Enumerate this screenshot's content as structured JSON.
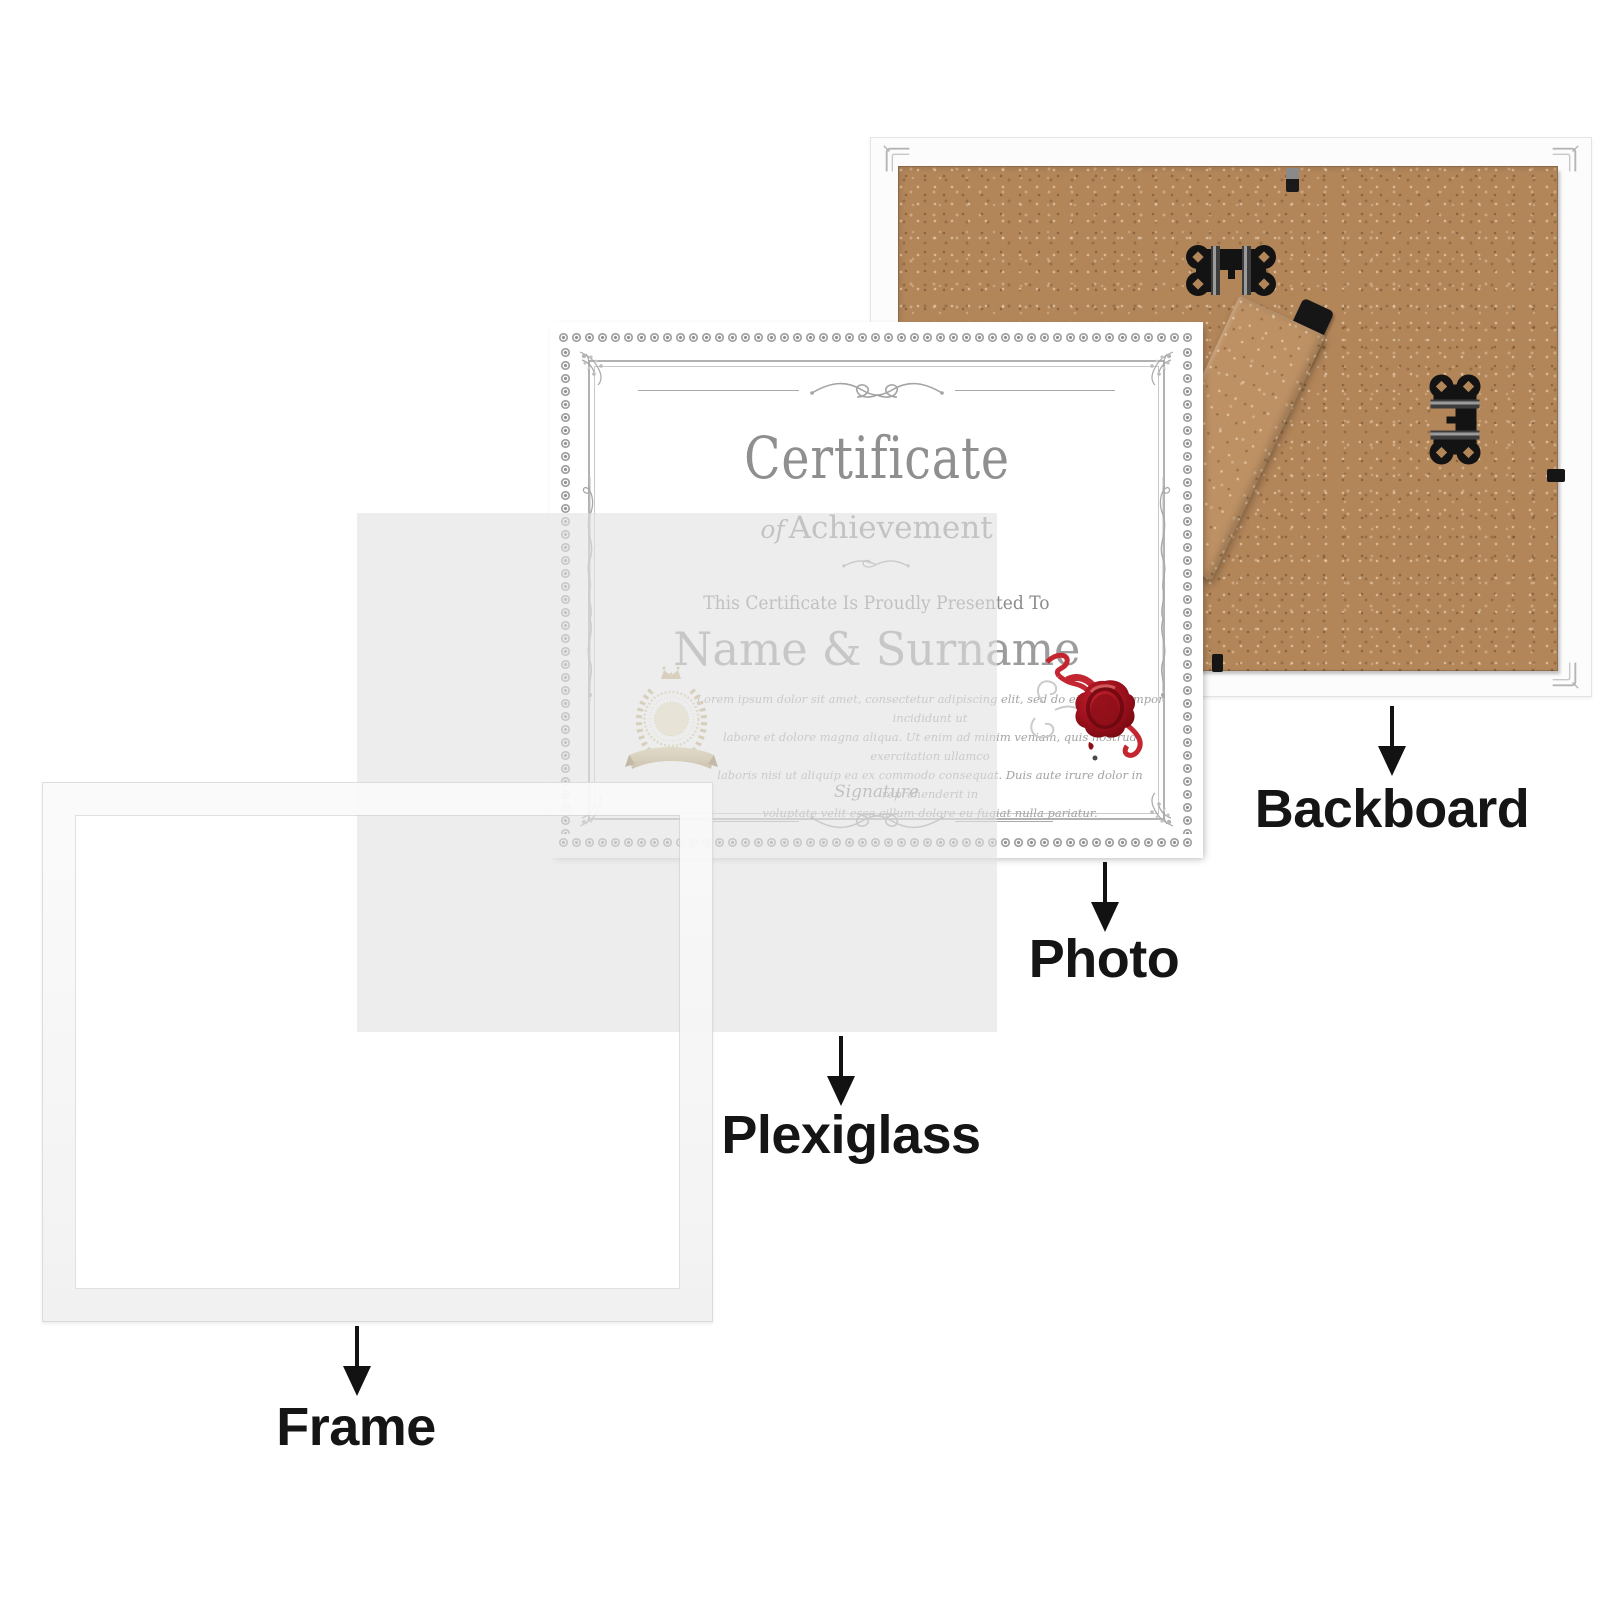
{
  "labels": {
    "frame": "Frame",
    "plexiglass": "Plexiglass",
    "photo": "Photo",
    "backboard": "Backboard"
  },
  "certificate": {
    "title": "Certificate",
    "subtitle_of": "of",
    "subtitle": "Achievement",
    "presented": "This Certificate Is Proudly Presented To",
    "recipient": "Name & Surname",
    "body_lines": [
      "Lorem ipsum dolor sit amet, consectetur adipiscing elit, sed do eiusmod tempor incididunt ut",
      "labore et dolore magna aliqua. Ut enim ad minim veniam, quis nostrud exercitation ullamco",
      "laboris nisi ut aliquip ea ex commodo consequat. Duis aute irure dolor in reprehenderit in",
      "voluptate velit esse cillum dolore eu fugiat nulla pariatur."
    ],
    "signature": "Signature"
  },
  "colors": {
    "page_bg": "#ffffff",
    "label_text": "#151515",
    "arrow": "#121212",
    "backboard_wood": "#b3865a",
    "backboard_frame_white": "#fcfcfc",
    "hardware_black": "#131313",
    "plexiglass_tint": "#ececec",
    "frame_white": "#f4f4f4",
    "certificate_ink": "#8f8f8f",
    "badge_gold": "#c9b382",
    "seal_red": "#9c101c"
  }
}
